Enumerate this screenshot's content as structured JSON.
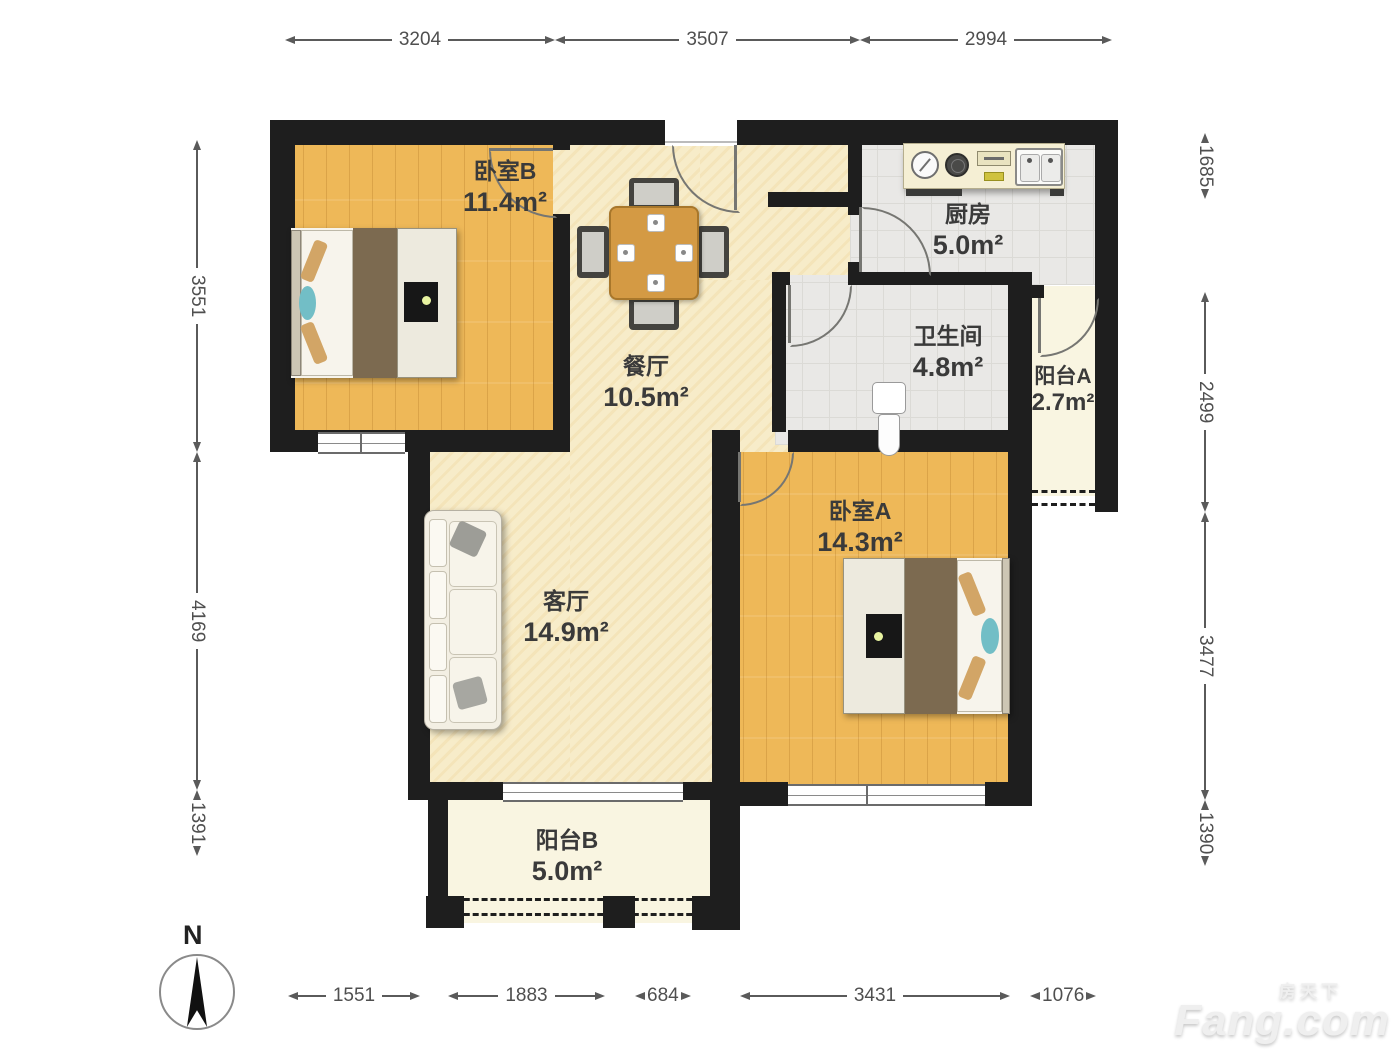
{
  "plan": {
    "rooms": {
      "bedroom_b": {
        "name": "卧室B",
        "area": "11.4m²"
      },
      "dining": {
        "name": "餐厅",
        "area": "10.5m²"
      },
      "kitchen": {
        "name": "厨房",
        "area": "5.0m²"
      },
      "bathroom": {
        "name": "卫生间",
        "area": "4.8m²"
      },
      "balcony_a": {
        "name": "阳台A",
        "area": "2.7m²"
      },
      "bedroom_a": {
        "name": "卧室A",
        "area": "14.3m²"
      },
      "living": {
        "name": "客厅",
        "area": "14.9m²"
      },
      "balcony_b": {
        "name": "阳台B",
        "area": "5.0m²"
      }
    },
    "dimensions_mm": {
      "top": [
        "3204",
        "3507",
        "2994"
      ],
      "bottom": [
        "1551",
        "1883",
        "684",
        "3431",
        "1076"
      ],
      "left": [
        "3551",
        "4169",
        "1391"
      ],
      "right": [
        "1685",
        "2499",
        "3477",
        "1390"
      ]
    },
    "compass": {
      "label": "N"
    },
    "watermark": {
      "brand_cn": "房天下",
      "brand_en": "Fang.com"
    },
    "colors": {
      "wall": "#1e1e1e",
      "wood_floor": "#eeb858",
      "shared_floor": "#f7ecc9",
      "tile_floor": "#e9e8e6",
      "balcony_floor": "#f9f5e1",
      "dimension_text": "#4f4f4f"
    }
  }
}
